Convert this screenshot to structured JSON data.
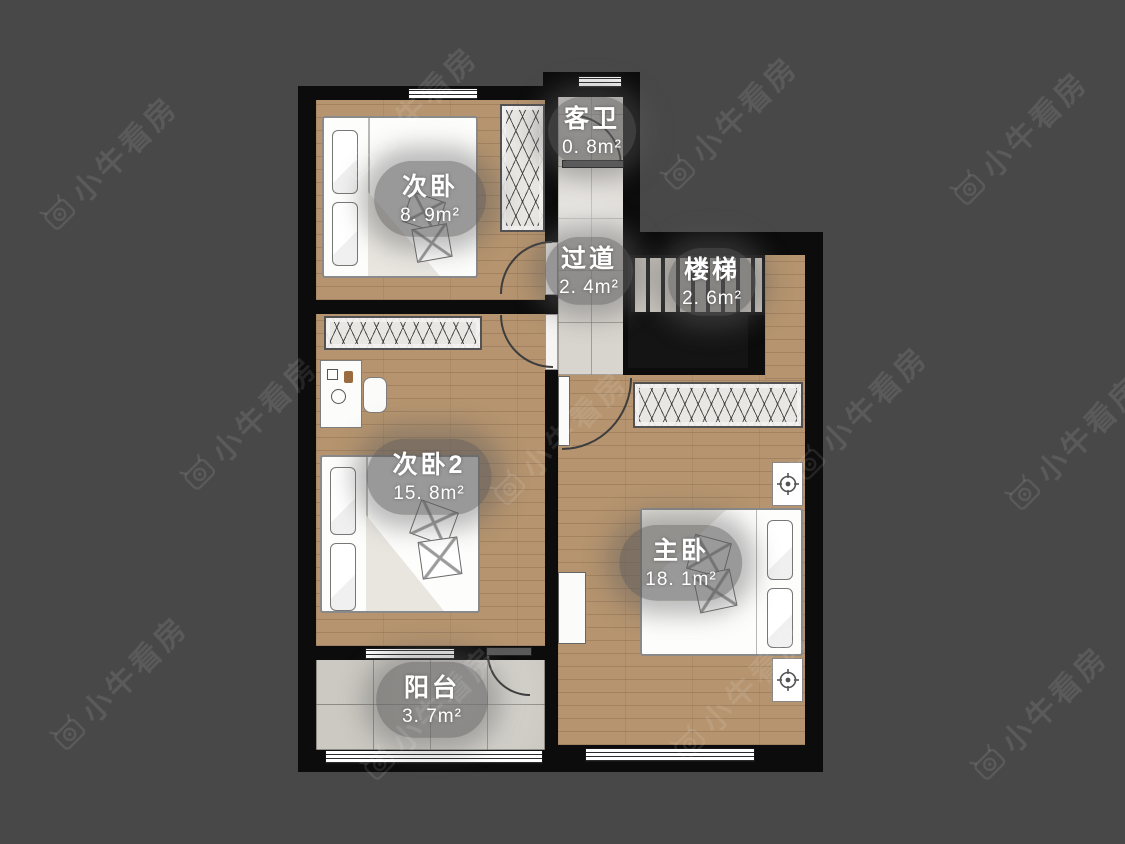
{
  "watermark": {
    "text": "小牛看房"
  },
  "rooms": [
    {
      "name": "次卧",
      "area": "8. 9m²"
    },
    {
      "name": "客卫",
      "area": "0. 8m²"
    },
    {
      "name": "过道",
      "area": "2. 4m²"
    },
    {
      "name": "楼梯",
      "area": "2. 6m²"
    },
    {
      "name": "次卧2",
      "area": "15. 8m²"
    },
    {
      "name": "主卧",
      "area": "18. 1m²"
    },
    {
      "name": "阳台",
      "area": "3. 7m²"
    }
  ],
  "colors": {
    "background": "#484848",
    "wall": "#0c0c0c",
    "wood_floor": "#b5946f",
    "tile_floor": "#d8d4ce",
    "balcony_tile": "#ccc9c2",
    "label_capsule": "#5c5c5c",
    "label_text": "#ffffff",
    "watermark": "#5e5e5e"
  }
}
